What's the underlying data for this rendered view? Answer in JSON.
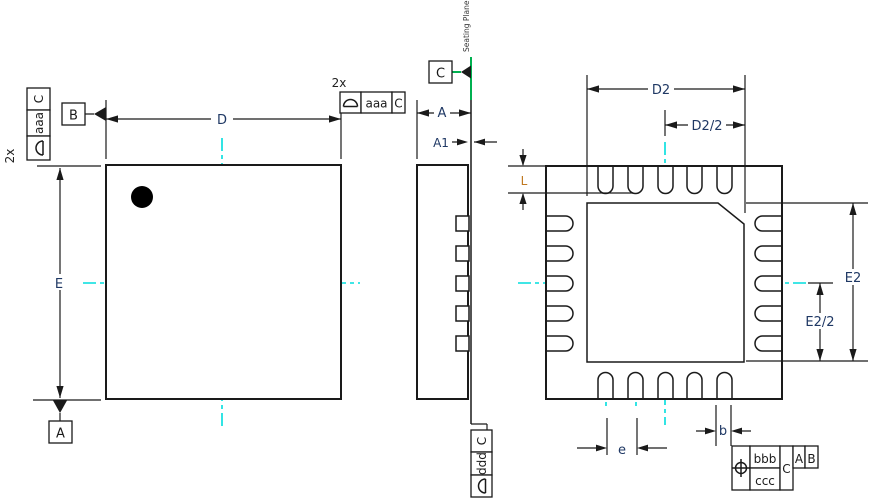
{
  "dimensions": {
    "d": "D",
    "e": "E",
    "a": "A",
    "a1": "A1",
    "l": "L",
    "pitch": "e",
    "b": "b",
    "d2": "D2",
    "d2_half": "D2/2",
    "e2": "E2",
    "e2_half": "E2/2"
  },
  "datums": {
    "a": "A",
    "b": "B",
    "c": "C"
  },
  "counts": {
    "top": "2x",
    "left": "2x"
  },
  "seating_plane": "Seating Plane",
  "fcf": {
    "left": {
      "tolerance": "aaa",
      "datum": "C"
    },
    "top": {
      "tolerance": "aaa",
      "datum": "C"
    },
    "bottom": {
      "tolerance": "ddd",
      "datum": "C"
    },
    "position": {
      "upper": "bbb",
      "lower": "ccc",
      "primary": "C",
      "secondary": "A",
      "tertiary": "B"
    }
  },
  "colors": {
    "line": "#1a1a1a",
    "centerline": "#00dede",
    "seating_plane": "#00b050",
    "dimension_text": "#1f3864"
  }
}
